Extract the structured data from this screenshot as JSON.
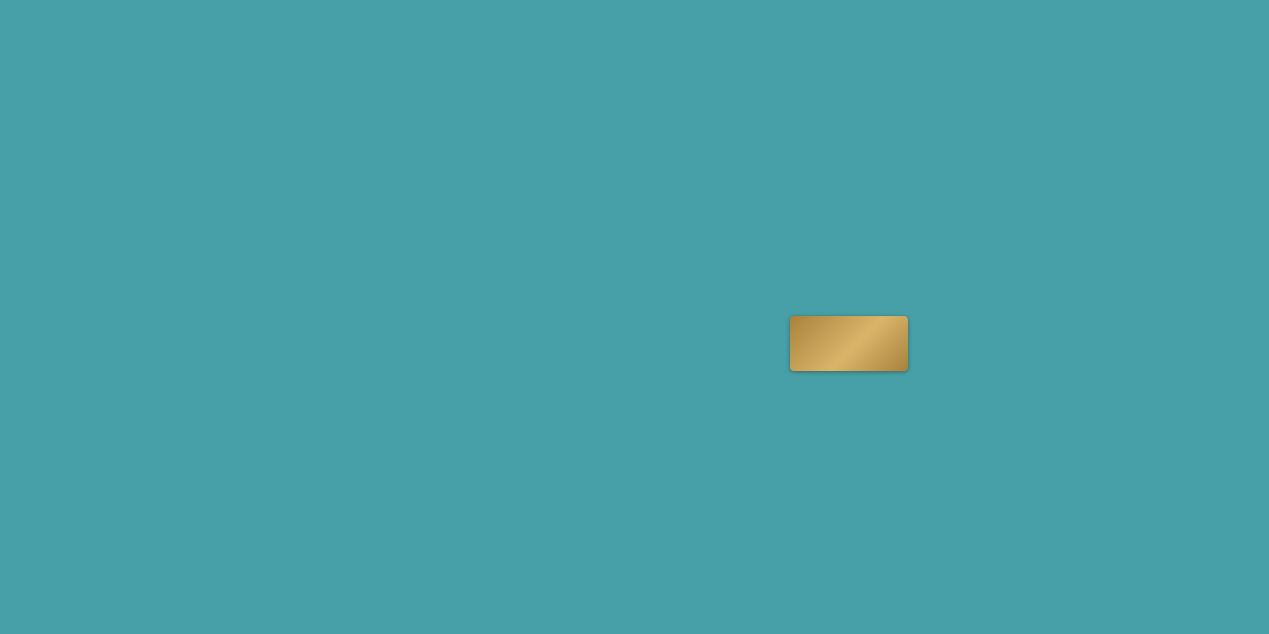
{
  "map_title_note": "Xiamen Xiang'an project location map",
  "colors": {
    "water": "#47A0A8",
    "land": "#EDE4CB",
    "land_light": "#F6EEDA",
    "road": "#2B2119",
    "rail_yellow": "#E9A92C",
    "metro_green": "#3FA45F",
    "metro_blue": "#4F7EC2",
    "metro_purple": "#C06CC8",
    "tunnel": "#CFA6DC",
    "cbd": "#B97F52",
    "park": "#86BD91",
    "accent_red": "#C03A2B",
    "gold": "#C29A52"
  },
  "project": {
    "logo": "长峰InhalT X",
    "diamond_icon": "❖"
  },
  "directions": {
    "shenhai": "沈海高速方向",
    "quanzhou": "泉州方向",
    "chevrons": "»»"
  },
  "area_labels": [
    {
      "t": "集美区",
      "x": 313,
      "y": 87,
      "s": 12
    },
    {
      "t": "东部市级中心",
      "x": 703,
      "y": 247,
      "s": 12.5
    },
    {
      "t": "南部新城\nCBD",
      "x": 838,
      "y": 256,
      "s": 12.5
    },
    {
      "t": "新会展片区",
      "x": 717,
      "y": 383,
      "s": 12.5
    },
    {
      "t": "五缘湾商圈",
      "x": 388,
      "y": 488,
      "s": 11.5
    },
    {
      "t": "SM商圈",
      "x": 345,
      "y": 605,
      "s": 12.5
    },
    {
      "t": "万达\n商圈",
      "x": 470,
      "y": 570,
      "s": 12.5
    }
  ],
  "stations": [
    {
      "n": "厦门北站",
      "x": 190,
      "y": 24,
      "line": "yellow",
      "lx": 190,
      "ly": 10,
      "lc": "dark"
    },
    {
      "n": "集美学村站",
      "x": 144,
      "y": 216,
      "line": "blue",
      "lx": 185,
      "ly": 219,
      "lc": "dark"
    },
    {
      "n": "诚毅站",
      "x": 176,
      "y": 518,
      "line": "blue",
      "lx": 209,
      "ly": 521,
      "lc": "dark"
    },
    {
      "n": "双十中学站",
      "x": 332,
      "y": 508,
      "line": "green",
      "lx": 377,
      "ly": 514,
      "lc": "dark"
    },
    {
      "n": "洪坑站",
      "x": 687,
      "y": 350,
      "line": "yellow",
      "lx": 650,
      "ly": 353,
      "lc": "dark"
    },
    {
      "n": "洋唐站",
      "x": 784,
      "y": 268,
      "line": "red",
      "lx": 817,
      "ly": 271,
      "lc": "red"
    },
    {
      "n": "彭厝北站",
      "x": 897,
      "y": 390,
      "line": "red",
      "lx": 937,
      "ly": 393,
      "lc": "red"
    },
    {
      "n": "欧厝站",
      "x": 884,
      "y": 422,
      "line": "red",
      "lx": 917,
      "ly": 425,
      "lc": "red"
    },
    {
      "n": "蔡厝站",
      "x": 1042,
      "y": 268,
      "line": "green",
      "lx": 1075,
      "ly": 271,
      "lc": "dark"
    },
    {
      "n": "彭厝站",
      "x": 1044,
      "y": 342,
      "line": "yellow",
      "lx": 1077,
      "ly": 345,
      "lc": "dark"
    }
  ],
  "landmarks": [
    {
      "n": "东亭",
      "icon": "pin",
      "ix": 183,
      "iy": 53,
      "lx": 190,
      "ly": 67
    },
    {
      "n": "潘涂",
      "icon": "pin",
      "ix": 188,
      "iy": 88,
      "lx": 193,
      "ly": 101
    },
    {
      "n": "后田",
      "icon": "pin",
      "ix": 198,
      "iy": 127,
      "lx": 204,
      "ly": 140
    },
    {
      "n": "厦门市第二医院",
      "icon": "hospital",
      "ix": 172,
      "iy": 172,
      "lx": 172,
      "ly": 186
    },
    {
      "n": "园博苑",
      "icon": "scenic",
      "ix": 20,
      "iy": 208,
      "lx": 48,
      "ly": 210,
      "white": true
    },
    {
      "n": "集美大学",
      "icon": "school",
      "ix": 188,
      "iy": 228,
      "lx": 196,
      "ly": 241
    },
    {
      "n": "IOI棕榈城",
      "icon": "goldlogo",
      "ix": 107,
      "iy": 158,
      "lx": 107,
      "ly": 174,
      "gold": true
    },
    {
      "n": "翔安井头小学",
      "icon": "school",
      "ix": 566,
      "iy": 80,
      "lx": 568,
      "ly": 94
    },
    {
      "n": "老鼠屿",
      "icon": "hill",
      "ix": 586,
      "iy": 80,
      "lx": 606,
      "ly": 82
    },
    {
      "n": "双过山",
      "icon": "hill",
      "ix": 601,
      "iy": 112,
      "lx": 619,
      "ly": 114
    },
    {
      "n": "鹏坡山",
      "icon": "hill",
      "ix": 538,
      "iy": 128,
      "lx": 557,
      "ly": 130
    },
    {
      "n": "西岩山",
      "icon": "hill",
      "ix": 650,
      "iy": 163,
      "lx": 659,
      "ly": 176
    },
    {
      "n": "汇景商墅",
      "icon": "shop",
      "ix": 796,
      "iy": 47,
      "lx": 799,
      "ly": 59
    },
    {
      "n": "翔安区政府",
      "icon": "star",
      "ix": 835,
      "iy": 58,
      "lx": 838,
      "ly": 71
    },
    {
      "n": "人力资源大厦",
      "icon": "building",
      "ix": 781,
      "iy": 68,
      "lx": 783,
      "ly": 82
    },
    {
      "n": "厦门南洋职业学院",
      "icon": "school",
      "ix": 905,
      "iy": 117,
      "lx": 918,
      "ly": 130
    },
    {
      "n": "厦门海洋职业技术学院",
      "icon": "school",
      "ix": 913,
      "iy": 151,
      "lx": 917,
      "ly": 164
    },
    {
      "n": "洪前小学",
      "icon": "school",
      "ix": 827,
      "iy": 163,
      "lx": 827,
      "ly": 176
    },
    {
      "n": "艺术中心",
      "icon": "pin",
      "ix": 906,
      "iy": 197,
      "lx": 929,
      "ly": 200
    },
    {
      "n": "市民公园",
      "icon": "parktree",
      "ix": 917,
      "iy": 224,
      "lx": 941,
      "ly": 226
    },
    {
      "n": "双十中学·初中部（在建中）",
      "icon": "school",
      "ix": 943,
      "iy": 240,
      "lx": 950,
      "ly": 253
    },
    {
      "n": "科技中学",
      "icon": "school",
      "ix": 827,
      "iy": 220,
      "lx": 853,
      "ly": 223
    },
    {
      "n": "海西\n国际",
      "icon": "info",
      "ix": 775,
      "iy": 211,
      "lx": 775,
      "ly": 229
    },
    {
      "n": "钟宅小学",
      "icon": "school",
      "ix": 703,
      "iy": 256,
      "lx": 703,
      "ly": 270
    },
    {
      "n": "翔安行政中心",
      "icon": "star",
      "ix": 908,
      "iy": 281,
      "lx": 910,
      "ly": 293
    },
    {
      "n": "厦门实验小学\n翔安校区（在建中）",
      "icon": "school",
      "ix": 917,
      "iy": 316,
      "lx": 921,
      "ly": 332
    },
    {
      "n": "视远小学（在建中）",
      "icon": "museum",
      "ix": 799,
      "iy": 303,
      "lx": 814,
      "ly": 313
    },
    {
      "n": "汪厝",
      "icon": "pin",
      "ix": 983,
      "iy": 323,
      "lx": 987,
      "ly": 335
    },
    {
      "n": "香山景区",
      "icon": "hill",
      "ix": 1007,
      "iy": 97,
      "lx": 1034,
      "ly": 99
    },
    {
      "n": "厦大翔安校区",
      "icon": "school",
      "ix": 1013,
      "iy": 146,
      "lx": 1016,
      "ly": 162
    },
    {
      "n": "厦大附属翔安医院（在建中）",
      "icon": "hospital",
      "ix": 1017,
      "iy": 187,
      "lx": 1026,
      "ly": 203
    },
    {
      "n": "王富山",
      "icon": "hill",
      "ix": 636,
      "iy": 404,
      "lx": 633,
      "ly": 416
    },
    {
      "n": "滨海公园\n（规划中）",
      "icon": "parktree",
      "ix": 659,
      "iy": 392,
      "lx": 684,
      "ly": 400
    },
    {
      "n": "悦海扬帆公园",
      "icon": "parktree",
      "ix": 655,
      "iy": 412,
      "lx": 693,
      "ly": 414
    },
    {
      "n": "翔安大道公园",
      "icon": "parktree",
      "ix": 722,
      "iy": 410,
      "lx": 754,
      "ly": 412
    },
    {
      "n": "张埭桥公园",
      "icon": "parktree",
      "ix": 790,
      "iy": 408,
      "lx": 807,
      "ly": 418
    },
    {
      "n": "中山华侨公园",
      "icon": "parktree",
      "ix": 699,
      "iy": 454,
      "lx": 729,
      "ly": 459
    },
    {
      "n": "海府码头",
      "icon": "info",
      "ix": 768,
      "iy": 540,
      "lx": 797,
      "ly": 542
    },
    {
      "n": "台南企业区域总部",
      "icon": "info",
      "ix": 859,
      "iy": 519,
      "lx": 845,
      "ly": 531
    },
    {
      "n": "澳头渔港特色文化小镇",
      "icon": "info",
      "ix": 836,
      "iy": 474,
      "lx": 884,
      "ly": 476
    },
    {
      "n": "曼特莱斯（规划中）",
      "icon": "info",
      "ix": 851,
      "iy": 488,
      "lx": 884,
      "ly": 490
    },
    {
      "n": "国际邮轮港",
      "icon": "info",
      "ix": 893,
      "iy": 503,
      "lx": 865,
      "ly": 502
    },
    {
      "n": "厦门彭厝学校",
      "icon": "school",
      "ix": 908,
      "iy": 439,
      "lx": 938,
      "ly": 442
    },
    {
      "n": "前浯",
      "icon": "pin",
      "ix": 939,
      "iy": 426,
      "lx": 955,
      "ly": 429
    },
    {
      "n": "大嶝码头",
      "icon": "info",
      "ix": 1203,
      "iy": 356,
      "lx": 1180,
      "ly": 357
    },
    {
      "n": "翔安机场",
      "icon": "plane",
      "ix": 1200,
      "iy": 401,
      "lx": 1200,
      "ly": 421
    },
    {
      "n": "金门湾大酒店",
      "icon": "info",
      "ix": 1139,
      "iy": 413,
      "lx": 1106,
      "ly": 412
    },
    {
      "n": "空港经济区",
      "icon": "info",
      "ix": 1187,
      "iy": 431,
      "lx": 1158,
      "ly": 431
    },
    {
      "n": "厦门高崎机场",
      "icon": "plane",
      "ix": 283,
      "iy": 438,
      "lx": 263,
      "ly": 460
    },
    {
      "n": "安兜小学",
      "icon": "school",
      "ix": 293,
      "iy": 504,
      "lx": 295,
      "ly": 517
    },
    {
      "n": "湖里区政府",
      "icon": "star",
      "ix": 362,
      "iy": 563,
      "lx": 363,
      "ly": 577
    },
    {
      "n": "两岸\n金融中心",
      "icon": "info",
      "ix": 480,
      "iy": 604,
      "lx": 474,
      "ly": 614
    },
    {
      "n": "五通客运码头",
      "icon": "info",
      "ix": 453,
      "iy": 469,
      "lx": 447,
      "ly": 486
    },
    {
      "n": "五通灯塔公园",
      "icon": "parktree",
      "ix": 452,
      "iy": 495,
      "lx": 449,
      "ly": 508
    },
    {
      "n": "市级奥体中心",
      "icon": "building",
      "ix": 697,
      "iy": 361,
      "lx": 694,
      "ly": 371
    }
  ],
  "plain_labels": [
    {
      "t": "体育馆（规划中）",
      "x": 933,
      "y": 209,
      "s": 8
    },
    {
      "t": "厦航生活区（在建中）",
      "x": 838,
      "y": 385,
      "s": 8.5
    },
    {
      "t": "双十中学高中部（在建中）",
      "x": 742,
      "y": 359,
      "s": 8.5
    },
    {
      "t": "仁恒城市综合体",
      "x": 738,
      "y": 344,
      "s": 8.5
    },
    {
      "t": "旭辉上城",
      "x": 730,
      "y": 328,
      "s": 8.5
    },
    {
      "t": "均蓝城市广场",
      "x": 812,
      "y": 284,
      "s": 8.5
    },
    {
      "t": "厦门\n刘五店中学",
      "x": 558,
      "y": 320,
      "s": 9
    },
    {
      "t": "海翔大道",
      "x": 0,
      "y": 0,
      "s": 0,
      "hidden": true
    }
  ],
  "park_boxes": [
    {
      "t": "鼓锣公园",
      "x": 864,
      "y": 301
    },
    {
      "t": "鼓锣公园",
      "x": 845,
      "y": 366
    },
    {
      "t": "桥江公园",
      "x": 803,
      "y": 470
    }
  ],
  "road_badges": [
    {
      "t": "沈海高速",
      "x": 297,
      "y": 37,
      "r": 0,
      "c": "black"
    },
    {
      "t": "海翔大道",
      "x": 687,
      "y": 38,
      "r": 0,
      "c": "black"
    },
    {
      "t": "同集路",
      "x": 243,
      "y": 113,
      "r": 90,
      "c": "black"
    },
    {
      "t": "翔安西路",
      "x": 668,
      "y": 145,
      "r": 90,
      "c": "black"
    },
    {
      "t": "翔安南路",
      "x": 757,
      "y": 199,
      "r": 90,
      "c": "black"
    },
    {
      "t": "翔安东路",
      "x": 905,
      "y": 178,
      "r": -4,
      "c": "black"
    },
    {
      "t": "翔安大道",
      "x": 883,
      "y": 322,
      "r": 90,
      "c": "black"
    },
    {
      "t": "成功大道",
      "x": 234,
      "y": 438,
      "r": 85,
      "c": "black"
    },
    {
      "t": "金尚路",
      "x": 385,
      "y": 588,
      "r": 55,
      "c": "black"
    },
    {
      "t": "翔安大桥",
      "x": 533,
      "y": 490,
      "r": -22,
      "c": "black"
    },
    {
      "t": "滨海东大道",
      "x": 928,
      "y": 461,
      "r": -18,
      "c": "black"
    },
    {
      "t": "大嶝大桥",
      "x": 1082,
      "y": 360,
      "r": 48,
      "c": "black"
    },
    {
      "t": "翔安隧道",
      "x": 412,
      "y": 580,
      "r": -18,
      "c": "purple"
    },
    {
      "t": "地铁3号线",
      "x": 500,
      "y": 450,
      "r": -15,
      "c": "green"
    },
    {
      "t": "城际R1线",
      "x": 845,
      "y": 401,
      "r": 6,
      "c": "yellow"
    }
  ],
  "icon_glyphs": {
    "pin": "●",
    "school": "▤",
    "hospital": "✚",
    "star": "★",
    "parktree": "♣",
    "info": "i",
    "plane": "✈",
    "hill": "▲",
    "building": "▦",
    "museum": "▥",
    "shop": "◆",
    "scenic": "◎",
    "goldlogo": "❖"
  },
  "line_colors": {
    "yellow": "#E9A92C",
    "green": "#3FA45F",
    "blue": "#4F7EC2",
    "red": "#C8372C"
  },
  "geometry": {
    "land": [
      "M472,0 C462,60 470,105 498,140 C520,170 528,210 524,255 C530,300 558,332 600,352 C640,370 658,392 646,418 C655,448 680,460 700,478 C692,515 676,538 700,568 C726,596 762,590 780,558 C790,528 778,500 800,482 C834,462 866,522 898,556 C930,588 968,540 1000,472 C1020,432 1060,432 1092,458 C1112,478 1118,508 1142,522 C1182,546 1232,540 1269,520 L1269,0 Z",
      "M0,0 L268,0 C258,55 266,92 251,148 C243,170 252,180 228,196 C196,219 156,239 118,264 C96,279 70,252 46,259 C28,264 12,243 0,240 Z",
      "M62,634 C72,580 92,540 132,506 C172,472 222,452 272,440 C312,430 352,422 382,406 C402,396 422,402 436,422 C452,444 458,472 472,462 C492,452 512,466 522,492 C542,512 572,532 602,562 C622,586 636,612 640,634 Z"
    ],
    "bays": [
      "M1036,96 C1078,70 1140,86 1172,122 C1210,162 1232,202 1269,226 L1269,300 C1222,312 1172,302 1140,280 C1102,256 1062,230 1044,192 C1028,156 1012,116 1036,96 Z"
    ],
    "islands": [
      "M1152,330 C1192,314 1242,320 1269,336 L1269,512 C1232,530 1184,526 1154,502 C1122,476 1104,440 1108,398 C1112,364 1128,344 1152,330 Z"
    ],
    "islets": [
      [
        1104,
        296,
        14,
        9
      ]
    ],
    "inlets": [
      "M392,446 C412,430 432,442 436,466 C442,496 432,526 416,546 C400,562 384,552 382,526 C380,496 382,464 392,446 Z"
    ],
    "circles": [
      {
        "cx": 701,
        "cy": 262,
        "rx": 70,
        "ry": 70
      },
      {
        "cx": 400,
        "cy": 494,
        "rx": 86,
        "ry": 86
      },
      {
        "cx": 350,
        "cy": 586,
        "rx": 60,
        "ry": 60
      },
      {
        "cx": 477,
        "cy": 560,
        "rx": 52,
        "ry": 52
      }
    ],
    "cbd": {
      "cx": 856,
      "cy": 318,
      "rx": 116,
      "ry": 104
    },
    "parks": [
      [
        838,
        298,
        28,
        16
      ],
      [
        846,
        366,
        30,
        12
      ],
      [
        801,
        470,
        30,
        14
      ],
      [
        690,
        402,
        22,
        28
      ],
      [
        742,
        424,
        26,
        12
      ],
      [
        700,
        456,
        20,
        12
      ],
      [
        715,
        622,
        30,
        16
      ],
      [
        600,
        352,
        24,
        14
      ]
    ],
    "roads": [
      {
        "d": "M0,38 L1012,38 C1030,40 1040,52 1058,55 L1269,55",
        "w": 5
      },
      {
        "d": "M30,0 C70,95 105,180 140,260 C180,315 230,372 282,428",
        "w": 5
      },
      {
        "d": "M96,0 C118,90 132,175 143,258",
        "w": 3.5
      },
      {
        "d": "M137,0 C133,50 128,100 124,150",
        "w": 3.5
      },
      {
        "d": "M248,0 C246,55 242,95 232,148 C226,180 234,210 256,240 C300,300 330,365 358,428",
        "w": 4
      },
      {
        "d": "M234,424 C233,460 234,500 240,540 C248,580 260,615 268,634",
        "w": 4
      },
      {
        "d": "M330,634 C360,602 398,568 440,536 C460,522 476,510 492,500",
        "w": 4
      },
      {
        "d": "M346,422 C390,452 432,484 470,518 C504,548 540,582 566,612 C576,622 582,628 586,634",
        "w": 5
      },
      {
        "d": "M452,536 C500,514 548,492 600,468 C650,446 700,424 744,404",
        "w": 5
      },
      {
        "d": "M654,0 C654,60 656,120 664,180 C670,225 678,270 682,320 C684,345 686,350 688,352 C700,372 716,382 736,390",
        "w": 4
      },
      {
        "d": "M758,0 C757,60 756,120 758,180 C760,225 766,268 776,305 C782,330 790,345 796,360",
        "w": 4
      },
      {
        "d": "M858,0 C860,70 866,140 872,210 C878,270 884,310 883,360 C882,415 868,458 846,492 C824,524 800,548 786,562",
        "w": 5
      },
      {
        "d": "M688,195 C760,188 840,180 920,170 C980,163 1040,157 1100,150 C1150,145 1210,143 1269,146",
        "w": 4
      },
      {
        "d": "M886,38 C920,130 960,220 1010,290 C1040,330 1070,360 1096,392 C1110,410 1116,436 1114,460",
        "w": 4
      },
      {
        "d": "M790,560 C850,515 890,485 935,462 C985,438 1040,430 1090,424 C1140,418 1180,400 1210,370",
        "w": 5
      },
      {
        "d": "M598,332 C648,362 700,390 752,414 C790,432 830,448 868,460",
        "w": 4
      },
      {
        "d": "M560,120 C580,170 610,230 640,290 C660,330 676,345 688,352",
        "w": 4
      },
      {
        "d": "M1204,368 C1182,420 1152,478 1122,540 C1102,580 1084,612 1072,634",
        "w": 4
      },
      {
        "d": "M1269,148 C1200,152 1140,160 1080,170",
        "w": 4
      }
    ],
    "rails": [
      {
        "d": "M0,22 L638,22",
        "c": "#E9A92C",
        "w": 3,
        "dash": "4 3"
      },
      {
        "d": "M638,22 C642,120 644,220 650,300 C654,332 664,344 688,352 C730,372 780,402 840,402 C880,402 920,382 962,364 C1000,348 1022,344 1046,342 C1092,340 1122,358 1150,388 C1172,412 1182,444 1176,478 C1170,520 1152,560 1136,590",
        "c": "#E9A92C",
        "w": 3,
        "dash": "4 3"
      },
      {
        "d": "M638,22 L974,22 C977,90 976,160 976,218 C976,262 998,300 1022,326 C1032,336 1040,340 1046,342",
        "c": "#E9A92C",
        "w": 3,
        "dash": "4 3"
      },
      {
        "d": "M8,632 C110,582 220,540 330,508 C370,496 420,480 458,468 C495,456 525,448 562,438 C612,424 662,404 702,376 C732,354 750,320 756,292 C758,278 764,268 776,268 L1040,268 C1068,268 1088,288 1108,312 C1138,348 1166,378 1188,398",
        "c": "#3FA45F",
        "w": 3,
        "dash": "1.5 4"
      },
      {
        "d": "M0,183 C50,196 100,209 144,216 C180,223 202,236 210,258 C206,320 196,392 188,452 C183,492 178,508 176,518 C172,560 172,598 172,634",
        "c": "#4F7EC2",
        "w": 3,
        "dash": "1.5 4"
      },
      {
        "d": "M866,0 C864,60 862,120 862,180 C862,240 868,282 876,322 C881,362 884,396 884,422 C884,458 876,498 862,536 C856,552 850,562 846,570",
        "c": "#C06CC8",
        "w": 3,
        "dash": "1.5 4"
      },
      {
        "d": "M302,634 C340,606 372,590 414,578 C462,564 504,546 544,524 C592,500 652,466 712,440 C762,418 800,414 832,412",
        "c": "#CFA6DC",
        "w": 5,
        "dash": "",
        "op": 0.8
      }
    ]
  }
}
